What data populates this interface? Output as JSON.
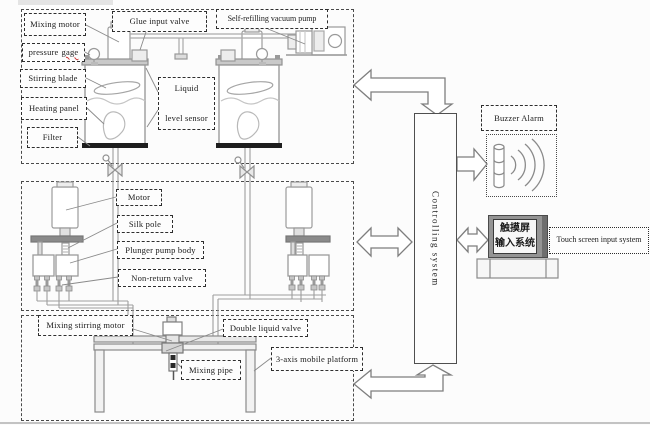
{
  "figure_type": "system-block-diagram",
  "colors": {
    "line_art": "#9b9b9b",
    "dark_line": "#555555",
    "text": "#1a1a1a",
    "filter_bar": "#1e1e1e",
    "spellcheck_underline": "#cc3333",
    "monitor_bezel": "#949494"
  },
  "sections": {
    "tank_unit": {
      "mixing_motor": "Mixing motor",
      "pressure_gage_word1": "pressure",
      "pressure_gage_word2": "gage",
      "stirring_blade": "Stirring blade",
      "heating_panel": "Heating panel",
      "filter": "Filter",
      "glue_input_valve": "Glue input valve",
      "vacuum_pump": "Self-refilling vacuum pump",
      "liquid_level_line1": "Liquid",
      "liquid_level_line2": "level sensor"
    },
    "pump_unit": {
      "motor": "Motor",
      "silk_pole": "Silk pole",
      "plunger_pump_body": "Plunger pump body",
      "non_return_valve": "Non-return valve"
    },
    "platform_unit": {
      "mixing_stirring_motor": "Mixing stirring motor",
      "double_liquid_valve": "Double liquid valve",
      "mixing_pipe": "Mixing pipe",
      "mobile_platform": "3-axis mobile platform"
    },
    "control_unit": {
      "controlling_system": "Controlling system",
      "buzzer_alarm": "Buzzer Alarm",
      "touch_screen_label": "Touch screen input system",
      "touch_screen_cn1": "触摸屏",
      "touch_screen_cn2": "输入系统"
    }
  },
  "icons": {
    "buzzer": "speaker-with-sound-waves-icon",
    "touch_screen": "monitor-with-stand-icon",
    "drain_valve": "bowtie-valve-icon",
    "connectors": "hollow-double-headed-arrows"
  }
}
